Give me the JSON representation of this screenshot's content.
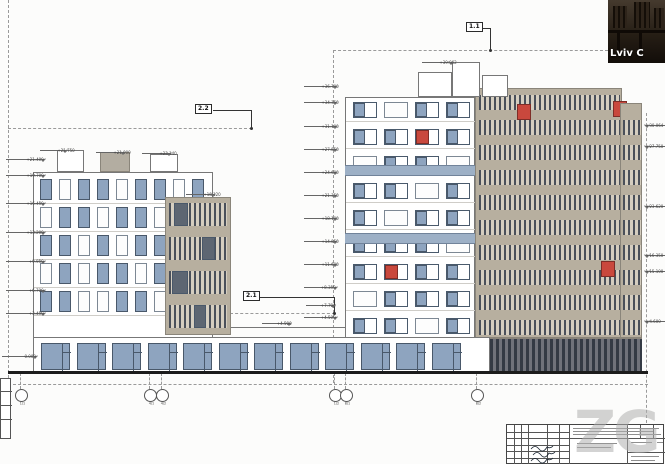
{
  "drawing": {
    "section_markers": {
      "top_left": "2.2",
      "top_right": "1.1",
      "middle": "2.1"
    },
    "left_building": {
      "roof_elevations": [
        "+21.750",
        "+21.900",
        "+23.140"
      ],
      "tower_elevation": "+18.120",
      "left_elevations": [
        "+21.400",
        "+19.700",
        "+16.450",
        "+13.200",
        "+9.950",
        "+6.700",
        "+3.450"
      ],
      "ground_elevation": "0.000",
      "window_rows": [
        "BWBBWBBWB",
        "WBBWBBWBW",
        "BBWBWBBWB",
        "WBWBBWBBW",
        "BBWWBBWBB"
      ],
      "tower_windows": [
        {
          "band": 0,
          "x": 8,
          "w": 14
        },
        {
          "band": 1,
          "x": 36,
          "w": 13
        },
        {
          "band": 2,
          "x": 6,
          "w": 16
        },
        {
          "band": 3,
          "x": 28,
          "w": 12
        }
      ]
    },
    "link_elevations": [
      "+7.700",
      "+4.500"
    ],
    "right_building": {
      "top_elevation": "+39.062",
      "left_elevations": [
        "+36.700",
        "+34.350",
        "+31.100",
        "+27.850",
        "+24.600",
        "+21.350",
        "+18.100",
        "+14.850",
        "+11.600",
        "+8.350",
        "+4.500"
      ],
      "right_elevations": [
        "+30.064",
        "+27.750",
        "+23.620",
        "+16.350",
        "+15.100",
        "+4.600"
      ],
      "window_rows": [
        "PWPP",
        "PPRP",
        "WPPW",
        "PPWP",
        "PWPP",
        "PPPW",
        "PRPP",
        "WPPP",
        "PPWP"
      ],
      "tan_red_panels": [
        {
          "x": 41,
          "y": 15
        },
        {
          "x": 137,
          "y": 12
        },
        {
          "x": 125,
          "y": 172
        }
      ]
    },
    "grid_bubbles": [
      "1/1",
      "4/1",
      "4/2",
      "1/2",
      "8/1",
      "8/2"
    ]
  },
  "camera_overlay": {
    "caption": "Lviv C"
  },
  "watermark": "ZG",
  "colors": {
    "window_glass": "#8ea4bf",
    "accent_red": "#c9483d",
    "facade_tan": "#b7af9f",
    "facade_white": "#ffffff"
  }
}
